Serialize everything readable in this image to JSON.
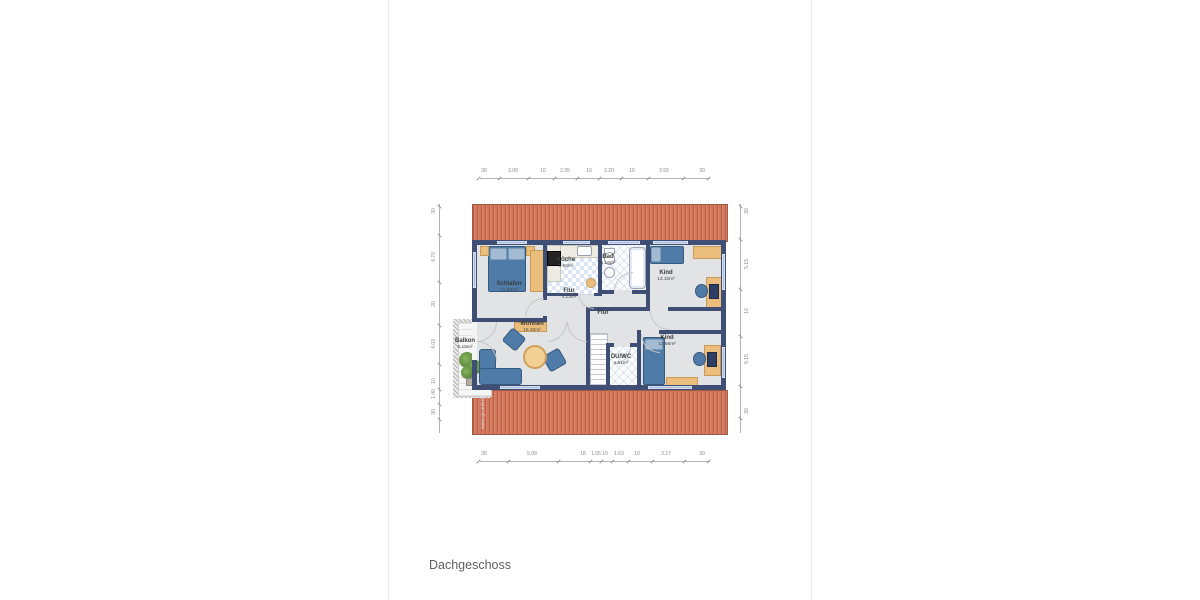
{
  "page": {
    "title": "Dachgeschoss",
    "watermark": "www.grundriss"
  },
  "rooms": {
    "schlafen": {
      "name": "Schlafen",
      "area": "11.08m²"
    },
    "kueche": {
      "name": "Küche",
      "area": "5.69m²"
    },
    "bad": {
      "name": "Bad",
      "area": "5.18m²"
    },
    "kind_top": {
      "name": "Kind",
      "area": "13.10m²"
    },
    "flur_top": {
      "name": "Flur",
      "area": "4.13m²"
    },
    "flur_main": {
      "name": "Flur",
      "area": ""
    },
    "wohnen": {
      "name": "Wohnen",
      "area": "19.32m²"
    },
    "balkon": {
      "name": "Balkon",
      "area": "5.15m²"
    },
    "du_wc": {
      "name": "DU/WC",
      "area": "4.51m²"
    },
    "kind_bottom": {
      "name": "Kind",
      "area": "12.66m²"
    }
  },
  "dimensions": {
    "top": [
      {
        "t": "30",
        "p": 4
      },
      {
        "t": "3.00",
        "p": 33
      },
      {
        "t": "10",
        "p": 63
      },
      {
        "t": "2.35",
        "p": 85
      },
      {
        "t": "10",
        "p": 109
      },
      {
        "t": "2.20",
        "p": 129
      },
      {
        "t": "10",
        "p": 152
      },
      {
        "t": "3.55",
        "p": 184
      },
      {
        "t": "30",
        "p": 222
      }
    ],
    "bottom": [
      {
        "t": "30",
        "p": 4
      },
      {
        "t": "5.08",
        "p": 52
      },
      {
        "t": "18",
        "p": 103
      },
      {
        "t": "1.05",
        "p": 116
      },
      {
        "t": "10",
        "p": 125
      },
      {
        "t": "1.63",
        "p": 139
      },
      {
        "t": "10",
        "p": 157
      },
      {
        "t": "3.27",
        "p": 186
      },
      {
        "t": "30",
        "p": 222
      }
    ],
    "left": [
      {
        "t": "30",
        "p": 8
      },
      {
        "t": "4.70",
        "p": 54
      },
      {
        "t": "20",
        "p": 101
      },
      {
        "t": "4.03",
        "p": 141
      },
      {
        "t": "10",
        "p": 178
      },
      {
        "t": "1.40",
        "p": 191
      },
      {
        "t": "30",
        "p": 209
      }
    ],
    "right": [
      {
        "t": "30",
        "p": 8
      },
      {
        "t": "5.15",
        "p": 61
      },
      {
        "t": "10",
        "p": 108
      },
      {
        "t": "5.15",
        "p": 156
      },
      {
        "t": "30",
        "p": 208
      }
    ]
  }
}
